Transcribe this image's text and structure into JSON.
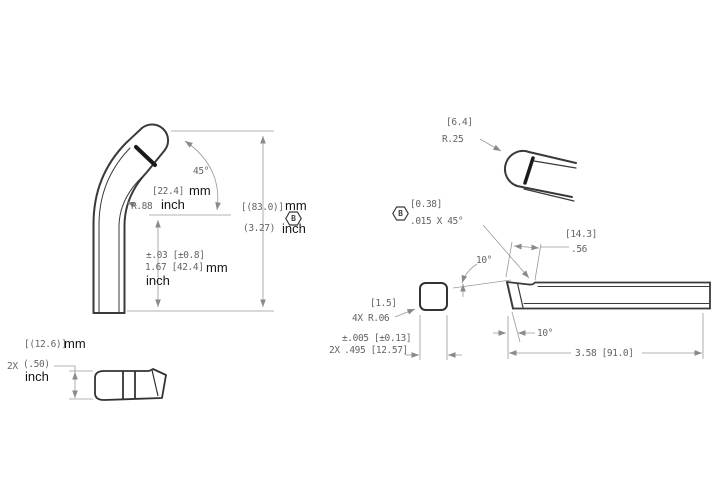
{
  "colors": {
    "object_line": "#3a3a3a",
    "dim_line": "#9a9a9a",
    "dim_text": "#646464",
    "unit_text": "#161616",
    "background": "#ffffff"
  },
  "bent_tube_view": {
    "bend_angle": "45°",
    "bend_radius_mm": "[22.4]",
    "bend_radius_mm_unit": "mm",
    "bend_radius_in": "R.88",
    "bend_radius_in_unit": "inch",
    "straight_height_tol": "±.03 [±0.8]",
    "straight_height_val": "1.67 [42.4]",
    "straight_height_mm_unit": "mm",
    "straight_height_in_unit": "inch",
    "overall_height_mm": "[(83.0)]",
    "overall_height_mm_unit": "mm",
    "overall_height_in": "(3.27)",
    "overall_height_in_unit": "inch",
    "overall_height_datum": "B"
  },
  "profile_view": {
    "height_mm": "[(12.6)]",
    "height_mm_unit": "mm",
    "height_qty": "2X",
    "height_in": "(.50)",
    "height_in_unit": "inch"
  },
  "tip_detail_view": {
    "tip_radius_mm": "[6.4]",
    "tip_radius_in": "R.25"
  },
  "bar_side_view": {
    "chamfer_datum": "B",
    "chamfer_mm": "[0.38]",
    "chamfer_in": ".015 X 45°",
    "rake_length_mm": "[14.3]",
    "rake_length_in": ".56",
    "top_rake_angle": "10°",
    "front_clearance_angle": "10°",
    "overall_length": "3.58 [91.0]"
  },
  "bar_end_view": {
    "corner_radius_mm": "[1.5]",
    "corner_radius_in": "4X R.06",
    "width_tol": "±.005 [±0.13]",
    "width_qty": "2X",
    "width_val": ".495 [12.57]"
  }
}
